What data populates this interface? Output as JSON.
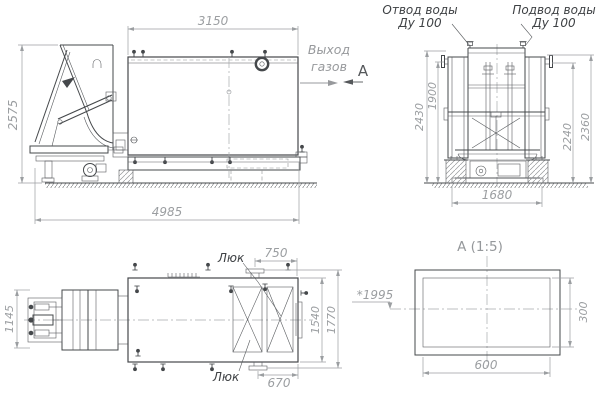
{
  "side_view": {
    "dim_width_top": "3150",
    "dim_height_left": "2575",
    "dim_length_bottom": "4985",
    "gas_outlet_label_line1": "Выход",
    "gas_outlet_label_line2": "газов",
    "section_marker": "А"
  },
  "end_view": {
    "water_outlet_label_line1": "Отвод воды",
    "water_outlet_label_line2": "Ду 100",
    "water_supply_label_line1": "Подвод воды",
    "water_supply_label_line2": "Ду 100",
    "dim_left_outer": "2430",
    "dim_left_inner": "1900",
    "dim_right_inner": "2240",
    "dim_right_outer": "2360",
    "dim_bottom": "1680"
  },
  "plan_view": {
    "hatch_label_top": "Люк",
    "hatch_label_bottom": "Люк",
    "dim_top": "750",
    "dim_bottom": "670",
    "dim_left": "1145",
    "dim_right_inner": "1540",
    "dim_right_outer": "1770",
    "dim_reference": "*1995"
  },
  "section_view": {
    "title": "А (1:5)",
    "dim_width": "600",
    "dim_height": "300"
  },
  "colors": {
    "outline": "#45484b",
    "dimension": "#9b9ea1",
    "label": "#3e4144",
    "background": "#ffffff"
  }
}
